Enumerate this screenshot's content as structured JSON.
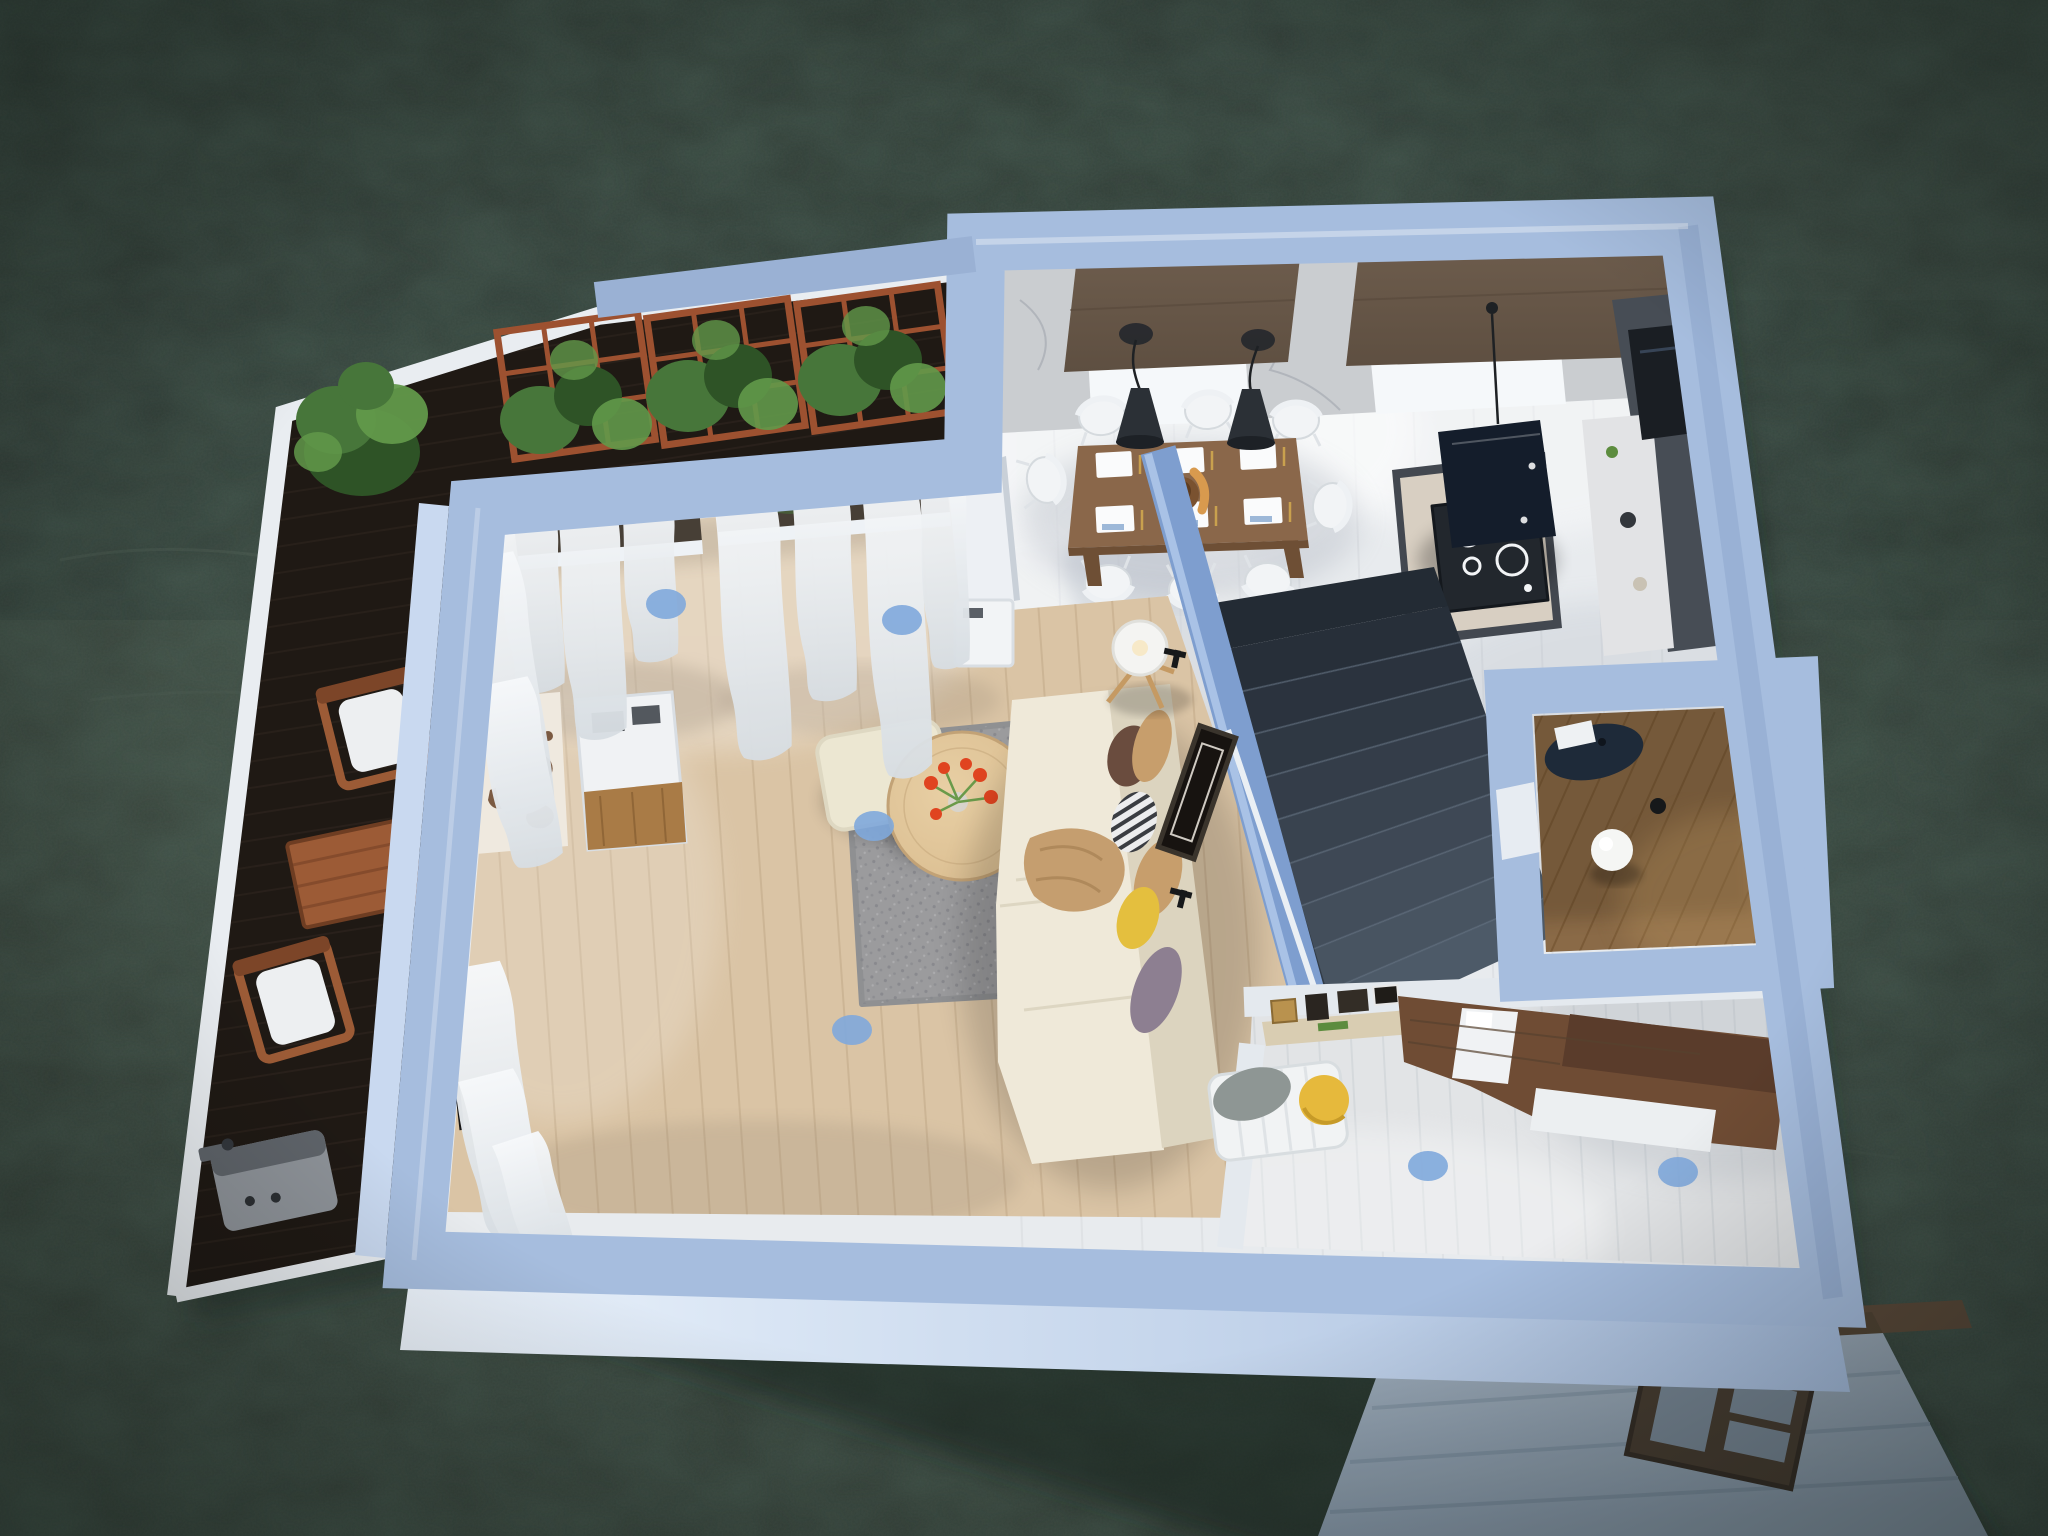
{
  "scene": {
    "type": "3d-floorplan-render",
    "view": "tilted top-down bird's eye",
    "environment": "single-storey apartment with terrace surrounded by dark green water",
    "hotspot_count": 6
  },
  "colors": {
    "water_base": "#3C4A41",
    "water_deep": "#2A3832",
    "water_light": "#4C5C50",
    "shadow": "#16201B",
    "wall": "#A6BDDE",
    "wall_bright": "#C9D9F0",
    "wall_shade": "#8CA6CC",
    "wall_face": "#D9E5F4",
    "fence": "#9AB1D4",
    "divider": "#7E9ECF",
    "divider_top": "#A9C2E6",
    "tile": "#E8EBEE",
    "tile_line": "#D7DADE",
    "marble": "#D5D8DC",
    "marble_vein": "#B4B9C0",
    "shade_brown": "#6F5E4E",
    "shade_brown_dark": "#5E4F41",
    "window_recess": "#F5F8FA",
    "window_dark": "#473F36",
    "wood": "#DAC4A5",
    "wood_line": "#C6AE8D",
    "deck": "#261F19",
    "deck_line": "#342A22",
    "deck_trim": "#E9EDF1",
    "trellis": "#9D5130",
    "leaf": "#47763A",
    "leaf_dark": "#2E5326",
    "leaf_light": "#62994A",
    "teak": "#9C5B36",
    "teak_dark": "#7C4528",
    "cushion": "#EDEFF1",
    "grill": "#8E9399",
    "grill_dark": "#5F646A",
    "island_side": "#434850",
    "island_top": "#D8CFC2",
    "cooktop": "#22272D",
    "hob_ring": "#F2F4F6",
    "hood": "#141D2B",
    "cabinet": "#474D55",
    "appliance": "#1A1E23",
    "counter": "#E2E3E5",
    "dining_table": "#8A674A",
    "table_edge": "#6E4F35",
    "chair": "#F2F4F6",
    "placemat": "#FAFBFC",
    "napkin": "#9DB8D8",
    "cutlery": "#C9A14E",
    "bowl": "#7A5230",
    "bread": "#D89A4E",
    "pendant": "#2B3036",
    "cord": "#1E2124",
    "stair_top": "#232B34",
    "stair_low": "#4D5A68",
    "stair_edge": "#5D6B7B",
    "rail": "#EAEFF4",
    "frame": "#171310",
    "sofa": "#EFE9D9",
    "sofa_shade": "#DCD4BF",
    "pillow_brown": "#6A4C3E",
    "pillow_tan": "#C79E6C",
    "pillow_yellow": "#E4BF3E",
    "pillow_plum": "#8D7F91",
    "pillow_bw": "#ECEDEE",
    "pillow_bw_stripe": "#3A3D42",
    "throw": "#C59E6F",
    "rug": "#9B9B9D",
    "rug_dark": "#84858A",
    "ctable": "#D9BC8F",
    "flower": "#E04420",
    "stem": "#6A9A4A",
    "vase": "#D8D4CC",
    "pouf": "#ECE7D2",
    "lamp": "#F4F4F2",
    "lamp_leg": "#C59A63",
    "console": "#F0F2F4",
    "console_wood": "#A97B46",
    "map_wall": "#EFE9DF",
    "map": "#7B5A42",
    "curtain": "#F6F8FA",
    "curtain_shade": "#D7DDE2",
    "rod": "#141414",
    "bath_floor": "#8A6A47",
    "bath_line": "#745531",
    "vanity": "#1E2A39",
    "sink": "#EEF1F3",
    "sphere": "#F5F6F4",
    "bed_floor": "#E2E4E6",
    "bed_floor_line": "#CDD2D6",
    "innerwall": "#E4E9EE",
    "walnut": "#6F4C34",
    "walnut_dark": "#5A3C2B",
    "mattress": "#F0F2F4",
    "bench": "#F1F3F4",
    "bench_gray": "#8E9694",
    "pouf_yellow": "#E6B93C",
    "shelf": "#D9CDB2",
    "frame_gold": "#B9924E",
    "frame_dark": "#2A2520",
    "book_green": "#5C8C3E",
    "hotspot": "#7FA9DC",
    "ext_stair": "#B3C2D3",
    "ext_stair_dark": "#93A5B8",
    "beam": "#5B4A3A",
    "gate": "#4E4136",
    "gate_slot": "#8FA5BA"
  },
  "objects": {
    "rooms": [
      "terrace-deck",
      "living-room",
      "dining-area",
      "kitchen",
      "staircase",
      "bathroom",
      "bedroom-office",
      "exterior-stairs"
    ],
    "furniture": {
      "terrace": [
        "trellis-planters",
        "potted-plant",
        "outdoor-chair",
        "outdoor-table",
        "outdoor-chair",
        "barbecue-grill"
      ],
      "living_room": [
        "sheer-curtains",
        "world-map-decor",
        "media-console",
        "pouf",
        "shag-rug",
        "coffee-table-with-tulips",
        "corner-sofa-with-pillows",
        "tripod-floor-lamp",
        "wall-art-frame"
      ],
      "dining": [
        "dining-table",
        "white-chairs",
        "place-settings",
        "fruit-bowl",
        "pendant-lamps",
        "roller-shades",
        "marble-wall"
      ],
      "kitchen": [
        "kitchen-island",
        "induction-cooktop",
        "range-hood",
        "tall-cabinets",
        "counter"
      ],
      "bathroom": [
        "oval-vanity",
        "sink",
        "sphere-lamp"
      ],
      "bedroom": [
        "wall-shelf-with-frames",
        "white-bench",
        "gray-cushion",
        "yellow-pouf",
        "walnut-bed-unit",
        "white-mattress"
      ],
      "exterior": [
        "concrete-steps",
        "timber-beam",
        "wooden-gate"
      ]
    }
  }
}
